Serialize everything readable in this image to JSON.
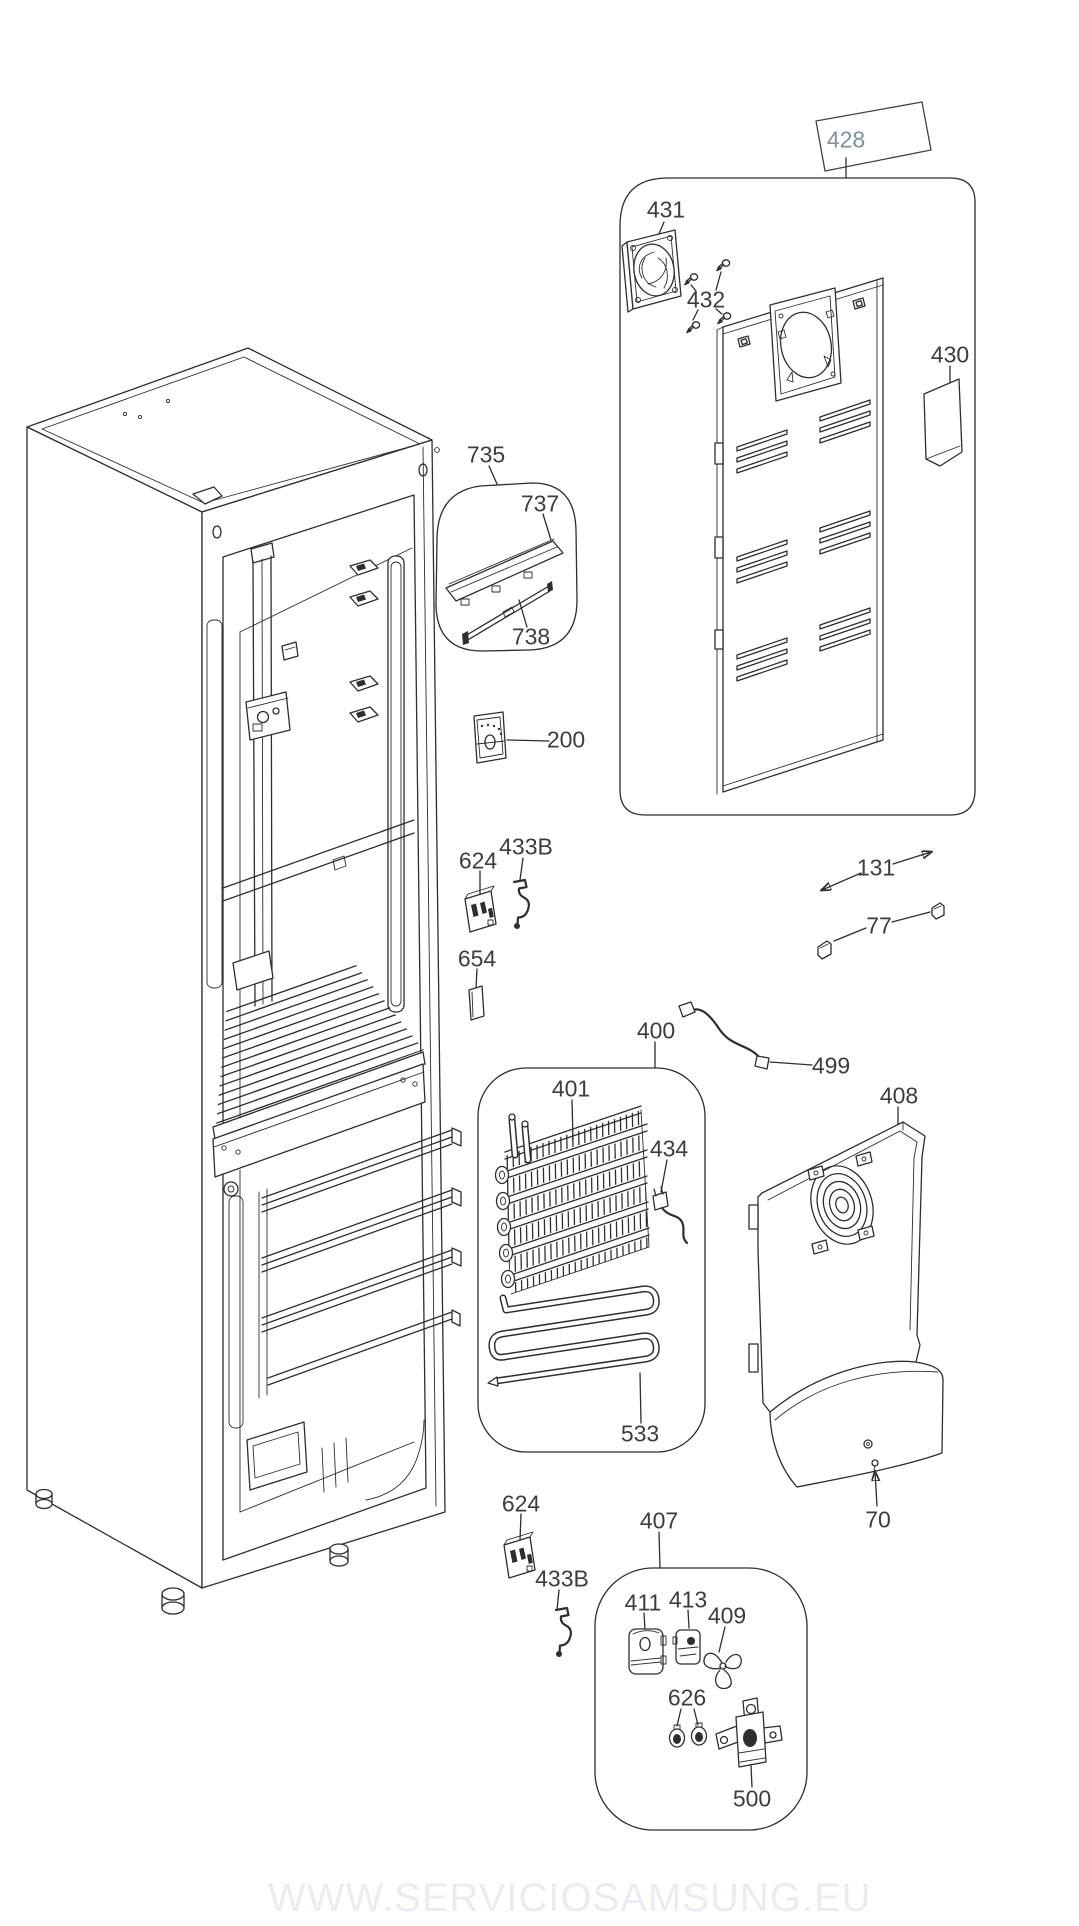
{
  "diagram": {
    "type": "exploded-parts-diagram",
    "watermark": "WWW.SERVICIOSAMSUNG.EU",
    "line_color": "#2e2e2e",
    "label_color": "#3d3d3d",
    "highlight": {
      "part": "428",
      "fill": "#c3e4f6",
      "text_color": "#7e909c"
    },
    "callouts": [
      {
        "part": "428",
        "x": 846,
        "y": 140,
        "highlighted": true
      },
      {
        "part": "431",
        "x": 666,
        "y": 210
      },
      {
        "part": "432",
        "x": 706,
        "y": 300
      },
      {
        "part": "430",
        "x": 950,
        "y": 355
      },
      {
        "part": "735",
        "x": 486,
        "y": 455
      },
      {
        "part": "737",
        "x": 540,
        "y": 504
      },
      {
        "part": "738",
        "x": 531,
        "y": 637
      },
      {
        "part": "200",
        "x": 566,
        "y": 740
      },
      {
        "part": "624",
        "x": 478,
        "y": 861
      },
      {
        "part": "433B",
        "x": 526,
        "y": 847
      },
      {
        "part": "654",
        "x": 477,
        "y": 959
      },
      {
        "part": "131",
        "x": 876,
        "y": 868
      },
      {
        "part": "77",
        "x": 879,
        "y": 926
      },
      {
        "part": "400",
        "x": 656,
        "y": 1031
      },
      {
        "part": "401",
        "x": 571,
        "y": 1089
      },
      {
        "part": "499",
        "x": 831,
        "y": 1066
      },
      {
        "part": "408",
        "x": 899,
        "y": 1096
      },
      {
        "part": "434",
        "x": 669,
        "y": 1149
      },
      {
        "part": "533",
        "x": 640,
        "y": 1434
      },
      {
        "part": "70",
        "x": 878,
        "y": 1520
      },
      {
        "part": "624",
        "x": 521,
        "y": 1504
      },
      {
        "part": "433B",
        "x": 562,
        "y": 1579
      },
      {
        "part": "407",
        "x": 659,
        "y": 1521
      },
      {
        "part": "411",
        "x": 643,
        "y": 1603
      },
      {
        "part": "413",
        "x": 688,
        "y": 1600
      },
      {
        "part": "409",
        "x": 727,
        "y": 1616
      },
      {
        "part": "626",
        "x": 687,
        "y": 1698
      },
      {
        "part": "500",
        "x": 752,
        "y": 1799
      }
    ],
    "assemblies": [
      {
        "label": "428",
        "contains": [
          "431",
          "432",
          "430"
        ]
      },
      {
        "label": "735",
        "contains": [
          "737",
          "738"
        ]
      },
      {
        "label": "400",
        "contains": [
          "401",
          "434",
          "533"
        ]
      },
      {
        "label": "407",
        "contains": [
          "411",
          "413",
          "409",
          "626",
          "500"
        ]
      }
    ]
  }
}
